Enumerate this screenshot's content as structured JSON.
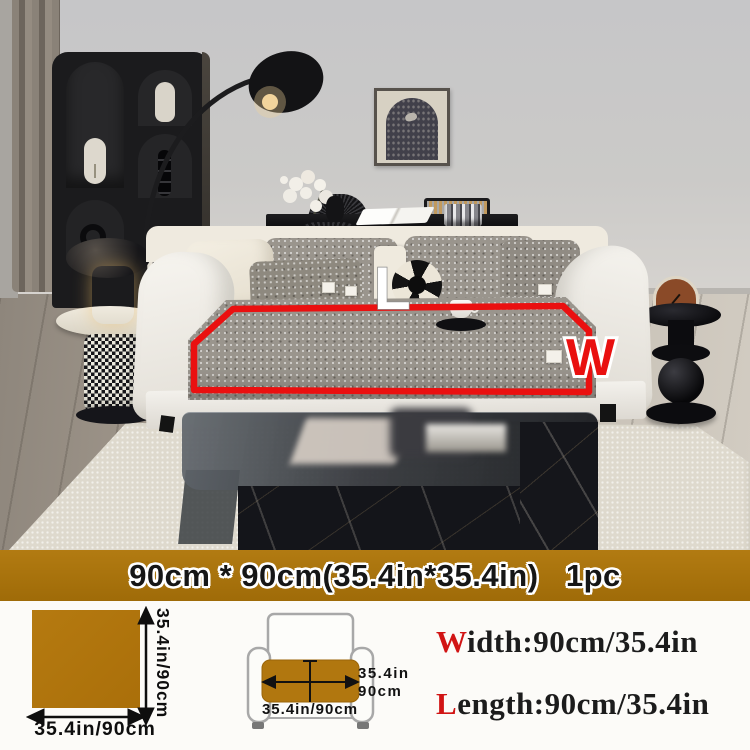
{
  "photo": {
    "annotation": {
      "length_marker": "L",
      "width_marker": "W",
      "outline_color": "#ea1010"
    }
  },
  "banner": {
    "text": "90cm * 90cm(35.4in*35.4in)   1pc",
    "background": "#a9720c"
  },
  "specs": {
    "swatch": {
      "color": "#b1770f",
      "height_label": "35.4in/90cm",
      "width_label": "35.4in/90cm"
    },
    "chair": {
      "seat_width_in": "35.4in",
      "seat_width_cm": "90cm",
      "seat_front_label": "35.4in/90cm"
    },
    "width_line": {
      "prefix": "W",
      "rest": "idth:90cm/35.4in"
    },
    "length_line": {
      "prefix": "L",
      "rest": "ength:90cm/35.4in"
    },
    "accent_color": "#d11414"
  }
}
